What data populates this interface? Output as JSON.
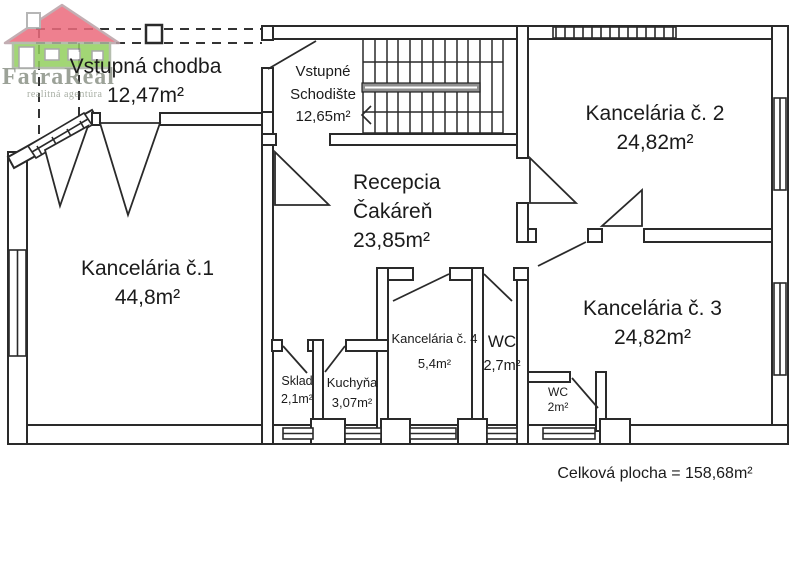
{
  "logo": {
    "title": "FatraReal",
    "subtitle": "realitná agentúra",
    "colors": {
      "roof": "#ec6b7c",
      "facade": "#92d05e",
      "text": "#8b9287",
      "subtext": "#98a094"
    }
  },
  "rooms": {
    "vstupna_chodba": {
      "name": "Vstupná chodba",
      "area": "12,47m²"
    },
    "vstupne_schodiste": {
      "name_line1": "Vstupné",
      "name_line2": "Schodište",
      "area": "12,65m²"
    },
    "kancelaria_2": {
      "name": "Kancelária č. 2",
      "area": "24,82m²"
    },
    "recepcia": {
      "name_line1": "Recepcia",
      "name_line2": "Čakáreň",
      "area": "23,85m²"
    },
    "kancelaria_1": {
      "name": "Kancelária č.1",
      "area": "44,8m²"
    },
    "kancelaria_3": {
      "name": "Kancelária č. 3",
      "area": "24,82m²"
    },
    "kancelaria_4": {
      "name": "Kancelária č. 4",
      "area": "5,4m²"
    },
    "wc_horny": {
      "name": "WC",
      "area": "2,7m²"
    },
    "sklad": {
      "name": "Sklad",
      "area": "2,1m²"
    },
    "kuchyna": {
      "name": "Kuchyňa",
      "area": "3,07m²"
    },
    "wc_dolny": {
      "name": "WC",
      "area": "2m²"
    }
  },
  "summary": {
    "total_area_label": "Celková plocha = 158,68m²"
  }
}
